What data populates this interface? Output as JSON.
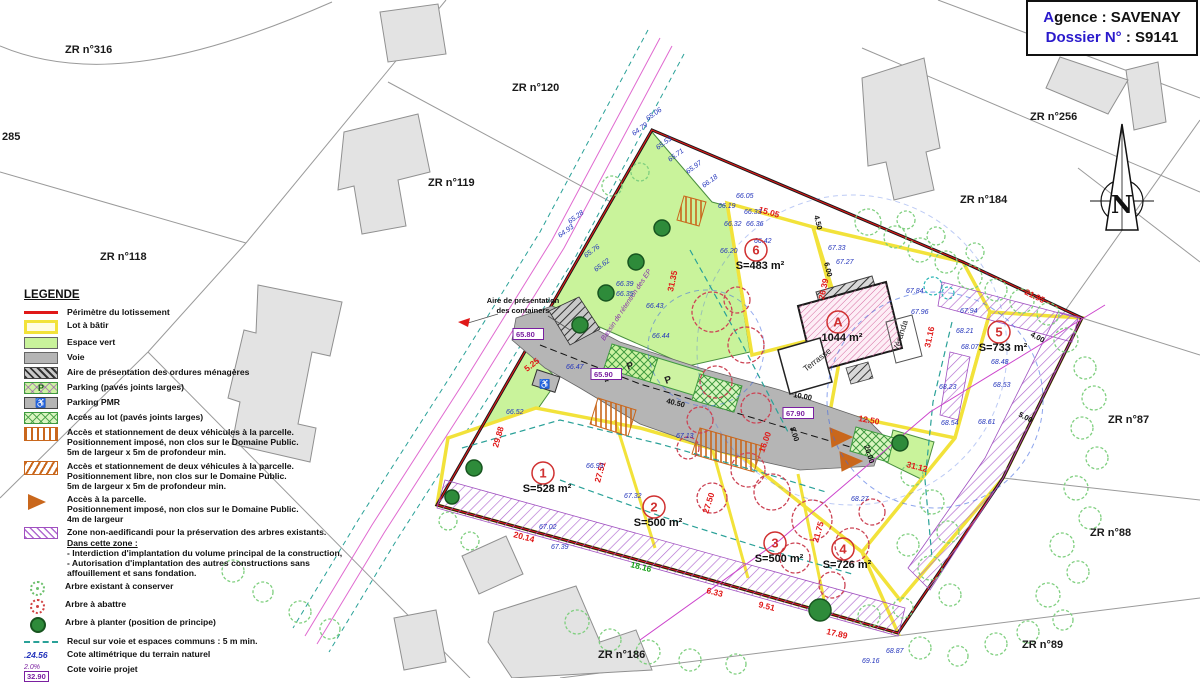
{
  "header": {
    "line1_blue": "A",
    "line1_rest": "gence : SAVENAY",
    "line2_blue": "Dossier N°",
    "line2_rest": " : S9141"
  },
  "north_label": "N",
  "legend": {
    "title": "LEGENDE",
    "items": [
      {
        "swatch": "sw-perimetre",
        "name": "perimeter-swatch",
        "lines": [
          "Périmètre du lotissement"
        ]
      },
      {
        "swatch": "sw-lot",
        "name": "lot-swatch",
        "lines": [
          "Lot à bâtir"
        ]
      },
      {
        "swatch": "sw-vert",
        "name": "espace-vert-swatch",
        "lines": [
          "Espace vert"
        ]
      },
      {
        "swatch": "sw-voie",
        "name": "voie-swatch",
        "lines": [
          "Voie"
        ]
      },
      {
        "swatch": "sw-ordures",
        "name": "ordures-swatch",
        "lines": [
          "Aire de présentation des ordures ménagères"
        ]
      },
      {
        "swatch": "sw-parking",
        "name": "parking-swatch",
        "swatch_text": "P",
        "lines": [
          "Parking (pavés joints larges)"
        ]
      },
      {
        "swatch": "sw-pmr",
        "name": "parking-pmr-swatch",
        "swatch_text": "♿",
        "lines": [
          "Parking PMR"
        ]
      },
      {
        "swatch": "sw-acces-lot",
        "name": "acces-lot-swatch",
        "lines": [
          "Accès au lot (pavés joints larges)"
        ]
      },
      {
        "swatch": "sw-acc2a",
        "name": "acces-impose-swatch",
        "lines": [
          "Accès et stationnement de deux véhicules à la parcelle.",
          "Positionnement imposé, non clos sur le Domaine Public.",
          "5m de largeur x 5m de profondeur min."
        ]
      },
      {
        "swatch": "sw-acc2b",
        "name": "acces-libre-swatch",
        "lines": [
          "Accès et stationnement de deux véhicules à la parcelle.",
          "Positionnement libre, non clos sur le Domaine Public.",
          "5m de largeur x 5m de profondeur min."
        ]
      },
      {
        "swatch": "sw-acc-parc",
        "name": "acces-parcelle-swatch",
        "lines": [
          "Accès à la parcelle.",
          "Positionnement imposé, non clos sur le Domaine Public.",
          "4m de largeur"
        ]
      },
      {
        "swatch": "sw-zone",
        "name": "zone-non-aedificandi-swatch",
        "lines": [
          "Zone non-aedificandi pour la préservation des arbres existants.",
          {
            "text": "Dans cette zone :",
            "u": true
          },
          " - Interdiction d'implantation du volume principal de la construction,",
          " - Autorisation d'implantation des autres constructions sans",
          "affouillement et sans fondation."
        ]
      },
      {
        "swatch": "sw-arb-cons",
        "name": "arbre-conserver-swatch",
        "lines": [
          "Arbre existant à conserver"
        ]
      },
      {
        "swatch": "sw-arb-abat",
        "name": "arbre-abattre-swatch",
        "lines": [
          "Arbre à abattre"
        ]
      },
      {
        "swatch": "sw-arb-plant",
        "name": "arbre-planter-swatch",
        "lines": [
          "Arbre à planter (position de principe)"
        ]
      },
      {
        "swatch": "sw-recul",
        "name": "recul-swatch",
        "lines": [
          "Recul sur voie et espaces communs : 5 m min."
        ]
      },
      {
        "swatch": "sw-cote-alti",
        "name": "cote-altimetrique-swatch",
        "swatch_text": ".24.56",
        "lines": [
          "Cote altimétrique du terrain naturel"
        ]
      },
      {
        "swatch": "sw-cote-voirie",
        "name": "cote-voirie-swatch",
        "swatch_text": "32.90",
        "swatch_text2": "2.0%",
        "lines": [
          "Cote voirie projet"
        ]
      }
    ]
  },
  "lots": [
    {
      "num": "1",
      "area": "S=528 m²",
      "cx": 543,
      "cy": 473
    },
    {
      "num": "2",
      "area": "S=500 m²",
      "cx": 654,
      "cy": 507
    },
    {
      "num": "3",
      "area": "S=500 m²",
      "cx": 775,
      "cy": 543
    },
    {
      "num": "4",
      "area": "S=726 m²",
      "cx": 843,
      "cy": 549
    },
    {
      "num": "5",
      "area": "S=733 m²",
      "cx": 999,
      "cy": 332
    },
    {
      "num": "6",
      "area": "S=483 m²",
      "cx": 756,
      "cy": 250
    },
    {
      "num": "A",
      "area": "1044 m²",
      "cx": 838,
      "cy": 322
    }
  ],
  "annotations": [
    {
      "t": "ZR n°316",
      "x": 65,
      "y": 53,
      "c": "zr"
    },
    {
      "t": "285",
      "x": 2,
      "y": 140,
      "c": "zr"
    },
    {
      "t": "ZR n°118",
      "x": 100,
      "y": 260,
      "c": "zr"
    },
    {
      "t": "ZR n°119",
      "x": 428,
      "y": 186,
      "c": "zr"
    },
    {
      "t": "ZR n°120",
      "x": 512,
      "y": 91,
      "c": "zr"
    },
    {
      "t": "ZR n°256",
      "x": 1030,
      "y": 120,
      "c": "zr"
    },
    {
      "t": "ZR n°184",
      "x": 960,
      "y": 203,
      "c": "zr"
    },
    {
      "t": "ZR n°87",
      "x": 1108,
      "y": 423,
      "c": "zr"
    },
    {
      "t": "ZR n°88",
      "x": 1090,
      "y": 536,
      "c": "zr"
    },
    {
      "t": "ZR n°89",
      "x": 1022,
      "y": 648,
      "c": "zr"
    },
    {
      "t": "ZR n°186",
      "x": 598,
      "y": 658,
      "c": "zr"
    },
    {
      "t": "Terrasse",
      "x": 806,
      "y": 372,
      "r": -38,
      "c": "bld"
    },
    {
      "t": "Véranda",
      "x": 898,
      "y": 352,
      "r": -72,
      "c": "bld"
    },
    {
      "t": "Aire de présentation",
      "x": 523,
      "y": 303,
      "a": "middle",
      "c": "note"
    },
    {
      "t": "des containers",
      "x": 523,
      "y": 313,
      "a": "middle",
      "c": "note"
    },
    {
      "t": "Bassin de rétention des EP",
      "x": 628,
      "y": 306,
      "r": -56,
      "a": "middle",
      "c": "note-purple"
    },
    {
      "t": "P",
      "x": 628,
      "y": 370,
      "r": -20,
      "c": "pletter"
    },
    {
      "t": "P",
      "x": 666,
      "y": 384,
      "r": -20,
      "c": "pletter"
    },
    {
      "t": "♿",
      "x": 539,
      "y": 387,
      "c": "pmrg"
    },
    {
      "t": "15.05",
      "x": 758,
      "y": 212,
      "r": 16,
      "c": "dim-red"
    },
    {
      "t": "31.35",
      "x": 673,
      "y": 292,
      "r": -78,
      "c": "dim-red"
    },
    {
      "t": "26.39",
      "x": 824,
      "y": 300,
      "r": -78,
      "c": "dim-red"
    },
    {
      "t": "31.16",
      "x": 930,
      "y": 348,
      "r": -78,
      "c": "dim-red"
    },
    {
      "t": "21.95",
      "x": 1024,
      "y": 294,
      "r": 26,
      "c": "dim-red"
    },
    {
      "t": "31.12",
      "x": 906,
      "y": 467,
      "r": 14,
      "c": "dim-red"
    },
    {
      "t": "12.50",
      "x": 858,
      "y": 421,
      "r": 10,
      "c": "dim-red"
    },
    {
      "t": "29.88",
      "x": 498,
      "y": 448,
      "r": -74,
      "c": "dim-red"
    },
    {
      "t": "27.51",
      "x": 600,
      "y": 483,
      "r": -74,
      "c": "dim-red"
    },
    {
      "t": "27.50",
      "x": 708,
      "y": 514,
      "r": -72,
      "c": "dim-red"
    },
    {
      "t": "21.75",
      "x": 818,
      "y": 543,
      "r": -74,
      "c": "dim-red"
    },
    {
      "t": "20.14",
      "x": 513,
      "y": 537,
      "r": 15,
      "c": "dim-red"
    },
    {
      "t": "17.89",
      "x": 826,
      "y": 634,
      "r": 13,
      "c": "dim-red"
    },
    {
      "t": "9.51",
      "x": 758,
      "y": 607,
      "r": 14,
      "c": "dim-red"
    },
    {
      "t": "6.33",
      "x": 706,
      "y": 593,
      "r": 14,
      "c": "dim-red"
    },
    {
      "t": "5.25",
      "x": 527,
      "y": 372,
      "r": -38,
      "c": "dim-red"
    },
    {
      "t": "16.00",
      "x": 764,
      "y": 453,
      "r": -70,
      "c": "dim-red"
    },
    {
      "t": "18.16",
      "x": 630,
      "y": 567,
      "r": 14,
      "c": "dim-green"
    },
    {
      "t": "4.50",
      "x": 814,
      "y": 216,
      "r": 76,
      "c": "dim-black"
    },
    {
      "t": "6.00",
      "x": 824,
      "y": 263,
      "r": 76,
      "c": "dim-black"
    },
    {
      "t": "10.00",
      "x": 793,
      "y": 397,
      "r": 10,
      "c": "dim-black"
    },
    {
      "t": "8.00",
      "x": 790,
      "y": 428,
      "r": 72,
      "c": "dim-black"
    },
    {
      "t": "20.00",
      "x": 864,
      "y": 446,
      "r": 72,
      "c": "dim-black"
    },
    {
      "t": "40.50",
      "x": 666,
      "y": 403,
      "r": 14,
      "c": "dim-black"
    },
    {
      "t": "4.00",
      "x": 606,
      "y": 383,
      "r": -38,
      "c": "dim-black"
    },
    {
      "t": "4.00",
      "x": 1030,
      "y": 336,
      "r": 28,
      "c": "dim-black"
    },
    {
      "t": "5.00",
      "x": 1018,
      "y": 416,
      "r": 28,
      "c": "dim-black"
    },
    {
      "t": "65.80",
      "x": 516,
      "y": 337,
      "c": "cote"
    },
    {
      "t": "65.90",
      "x": 594,
      "y": 377,
      "c": "cote"
    },
    {
      "t": "67.90",
      "x": 786,
      "y": 416,
      "c": "cote"
    },
    {
      "t": "65.06",
      "x": 648,
      "y": 121,
      "r": -36
    },
    {
      "t": "64.79",
      "x": 634,
      "y": 136,
      "r": -36
    },
    {
      "t": "65.53",
      "x": 658,
      "y": 150,
      "r": -36
    },
    {
      "t": "65.71",
      "x": 670,
      "y": 162,
      "r": -36
    },
    {
      "t": "65.97",
      "x": 688,
      "y": 174,
      "r": -36
    },
    {
      "t": "66.18",
      "x": 704,
      "y": 188,
      "r": -36
    },
    {
      "t": "66.05",
      "x": 736,
      "y": 198
    },
    {
      "t": "66.19",
      "x": 718,
      "y": 208
    },
    {
      "t": "66.33",
      "x": 744,
      "y": 214
    },
    {
      "t": "66.32",
      "x": 724,
      "y": 226
    },
    {
      "t": "66.36",
      "x": 746,
      "y": 226
    },
    {
      "t": "66.42",
      "x": 754,
      "y": 243
    },
    {
      "t": "66.20",
      "x": 720,
      "y": 253
    },
    {
      "t": "65.28",
      "x": 570,
      "y": 224,
      "r": -36
    },
    {
      "t": "64.93",
      "x": 560,
      "y": 238,
      "r": -36
    },
    {
      "t": "65.76",
      "x": 586,
      "y": 258,
      "r": -36
    },
    {
      "t": "65.62",
      "x": 596,
      "y": 272,
      "r": -36
    },
    {
      "t": "66.39",
      "x": 616,
      "y": 286
    },
    {
      "t": "66.35",
      "x": 616,
      "y": 296
    },
    {
      "t": "66.43",
      "x": 646,
      "y": 308
    },
    {
      "t": "66.44",
      "x": 652,
      "y": 338
    },
    {
      "t": "66.47",
      "x": 566,
      "y": 369
    },
    {
      "t": "66.52",
      "x": 506,
      "y": 414
    },
    {
      "t": "66.93",
      "x": 586,
      "y": 468
    },
    {
      "t": "67.02",
      "x": 539,
      "y": 529
    },
    {
      "t": "67.39",
      "x": 551,
      "y": 549
    },
    {
      "t": "67.32",
      "x": 624,
      "y": 498
    },
    {
      "t": "67.13",
      "x": 676,
      "y": 438
    },
    {
      "t": "67.33",
      "x": 828,
      "y": 250
    },
    {
      "t": "67.27",
      "x": 836,
      "y": 264
    },
    {
      "t": "67.84",
      "x": 906,
      "y": 293
    },
    {
      "t": "67.96",
      "x": 911,
      "y": 314
    },
    {
      "t": "67.94",
      "x": 960,
      "y": 313
    },
    {
      "t": "68.21",
      "x": 956,
      "y": 333
    },
    {
      "t": "68.07",
      "x": 961,
      "y": 349
    },
    {
      "t": "68.48",
      "x": 991,
      "y": 364
    },
    {
      "t": "68.53",
      "x": 993,
      "y": 387
    },
    {
      "t": "68.23",
      "x": 939,
      "y": 389
    },
    {
      "t": "68.54",
      "x": 941,
      "y": 425
    },
    {
      "t": "68.61",
      "x": 978,
      "y": 424
    },
    {
      "t": "68.27",
      "x": 851,
      "y": 501
    },
    {
      "t": "68.87",
      "x": 886,
      "y": 653
    },
    {
      "t": "69.16",
      "x": 862,
      "y": 663
    }
  ]
}
